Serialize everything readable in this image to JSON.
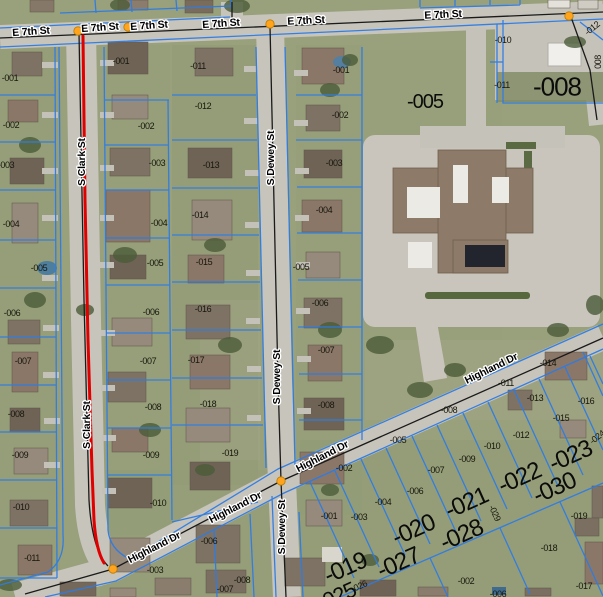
{
  "app": {
    "description": "GIS aerial parcel map viewer with highlighted route"
  },
  "colors": {
    "parcel_line": "#2d7ce6",
    "highlight_route": "#e10000",
    "intersection_node": "#ffa41c",
    "intersection_node_edge": "#b97a00",
    "road_fill": "#c7c4bb",
    "centerline": "#1a1a1a",
    "label_halo": "#ffffff"
  },
  "highlight": {
    "street": "S Clark St",
    "color": "#e10000"
  },
  "streets": {
    "labels": [
      {
        "text": "E 7th St",
        "x": 31,
        "y": 31,
        "angle": -4
      },
      {
        "text": "E 7th St",
        "x": 100,
        "y": 27,
        "angle": -4
      },
      {
        "text": "E 7th St",
        "x": 149,
        "y": 25,
        "angle": -4
      },
      {
        "text": "E 7th St",
        "x": 221,
        "y": 23,
        "angle": -4
      },
      {
        "text": "E 7th St",
        "x": 306,
        "y": 20,
        "angle": -3
      },
      {
        "text": "E 7th St",
        "x": 443,
        "y": 14,
        "angle": -3
      },
      {
        "text": "S Clark St",
        "x": 81,
        "y": 162,
        "angle": -90
      },
      {
        "text": "S Clark St",
        "x": 86,
        "y": 425,
        "angle": -90
      },
      {
        "text": "S Dewey St",
        "x": 270,
        "y": 158,
        "angle": -90
      },
      {
        "text": "S Dewey St",
        "x": 276,
        "y": 377,
        "angle": -90
      },
      {
        "text": "S Dewey St",
        "x": 281,
        "y": 527,
        "angle": -90
      },
      {
        "text": "Highland Dr",
        "x": 154,
        "y": 547,
        "angle": -27
      },
      {
        "text": "Highland Dr",
        "x": 235,
        "y": 507,
        "angle": -27
      },
      {
        "text": "Highland Dr",
        "x": 322,
        "y": 456,
        "angle": -27
      },
      {
        "text": "Highland Dr",
        "x": 491,
        "y": 368,
        "angle": -26
      }
    ]
  },
  "parcels": {
    "small_labels": [
      {
        "text": "-001",
        "x": 10,
        "y": 78
      },
      {
        "text": "-002",
        "x": 11,
        "y": 125
      },
      {
        "text": "-003",
        "x": 6,
        "y": 165
      },
      {
        "text": "-004",
        "x": 11,
        "y": 224
      },
      {
        "text": "-005",
        "x": 39,
        "y": 268
      },
      {
        "text": "-006",
        "x": 12,
        "y": 313
      },
      {
        "text": "-007",
        "x": 23,
        "y": 361
      },
      {
        "text": "-008",
        "x": 16,
        "y": 414
      },
      {
        "text": "-009",
        "x": 20,
        "y": 455
      },
      {
        "text": "-010",
        "x": 21,
        "y": 507
      },
      {
        "text": "-011",
        "x": 32,
        "y": 558
      },
      {
        "text": "-001",
        "x": 121,
        "y": 61
      },
      {
        "text": "-002",
        "x": 146,
        "y": 126
      },
      {
        "text": "-003",
        "x": 157,
        "y": 163
      },
      {
        "text": "-004",
        "x": 159,
        "y": 223
      },
      {
        "text": "-005",
        "x": 155,
        "y": 263
      },
      {
        "text": "-006",
        "x": 151,
        "y": 312
      },
      {
        "text": "-007",
        "x": 148,
        "y": 361
      },
      {
        "text": "-008",
        "x": 153,
        "y": 407
      },
      {
        "text": "-009",
        "x": 151,
        "y": 455
      },
      {
        "text": "-010",
        "x": 158,
        "y": 503
      },
      {
        "text": "-011",
        "x": 198,
        "y": 66
      },
      {
        "text": "-012",
        "x": 203,
        "y": 106
      },
      {
        "text": "-013",
        "x": 211,
        "y": 165
      },
      {
        "text": "-014",
        "x": 200,
        "y": 215
      },
      {
        "text": "-015",
        "x": 204,
        "y": 262
      },
      {
        "text": "-016",
        "x": 203,
        "y": 309
      },
      {
        "text": "-017",
        "x": 196,
        "y": 360
      },
      {
        "text": "-018",
        "x": 208,
        "y": 404
      },
      {
        "text": "-019",
        "x": 230,
        "y": 453
      },
      {
        "text": "-001",
        "x": 341,
        "y": 70
      },
      {
        "text": "-002",
        "x": 340,
        "y": 115
      },
      {
        "text": "-003",
        "x": 334,
        "y": 163
      },
      {
        "text": "-004",
        "x": 324,
        "y": 210
      },
      {
        "text": "-005",
        "x": 301,
        "y": 267
      },
      {
        "text": "-006",
        "x": 320,
        "y": 303
      },
      {
        "text": "-007",
        "x": 326,
        "y": 350
      },
      {
        "text": "-008",
        "x": 326,
        "y": 405
      },
      {
        "text": "-010",
        "x": 503,
        "y": 40
      },
      {
        "text": "-011",
        "x": 502,
        "y": 85
      },
      {
        "text": "-012",
        "x": 592,
        "y": 28,
        "angle": -38
      },
      {
        "text": "008",
        "x": 598,
        "y": 62,
        "angle": -90
      },
      {
        "text": "-014",
        "x": 548,
        "y": 363
      },
      {
        "text": "-011",
        "x": 506,
        "y": 383
      },
      {
        "text": "-013",
        "x": 535,
        "y": 398
      },
      {
        "text": "-016",
        "x": 586,
        "y": 401
      },
      {
        "text": "-008",
        "x": 449,
        "y": 410
      },
      {
        "text": "-015",
        "x": 561,
        "y": 418
      },
      {
        "text": "-012",
        "x": 521,
        "y": 435
      },
      {
        "text": "-024",
        "x": 597,
        "y": 437,
        "angle": -38
      },
      {
        "text": "-005",
        "x": 398,
        "y": 440
      },
      {
        "text": "-010",
        "x": 492,
        "y": 446
      },
      {
        "text": "-009",
        "x": 467,
        "y": 459
      },
      {
        "text": "-002",
        "x": 344,
        "y": 468
      },
      {
        "text": "-007",
        "x": 436,
        "y": 470
      },
      {
        "text": "-006",
        "x": 415,
        "y": 491
      },
      {
        "text": "-004",
        "x": 383,
        "y": 502
      },
      {
        "text": "-029",
        "x": 495,
        "y": 513,
        "angle": 65
      },
      {
        "text": "-001",
        "x": 329,
        "y": 516
      },
      {
        "text": "-003",
        "x": 359,
        "y": 517
      },
      {
        "text": "-019",
        "x": 579,
        "y": 516
      },
      {
        "text": "-006",
        "x": 209,
        "y": 541
      },
      {
        "text": "-018",
        "x": 549,
        "y": 548
      },
      {
        "text": "-003",
        "x": 155,
        "y": 570
      },
      {
        "text": "-008",
        "x": 242,
        "y": 580
      },
      {
        "text": "-002",
        "x": 466,
        "y": 581
      },
      {
        "text": "-026",
        "x": 359,
        "y": 586,
        "angle": -24
      },
      {
        "text": "-017",
        "x": 584,
        "y": 586
      },
      {
        "text": "-007",
        "x": 225,
        "y": 589
      },
      {
        "text": "-006",
        "x": 498,
        "y": 594
      }
    ],
    "large_labels": [
      {
        "text": "-005",
        "x": 425,
        "y": 101,
        "size": 20
      },
      {
        "text": "-008",
        "x": 557,
        "y": 86,
        "size": 26
      },
      {
        "text": "-019",
        "x": 345,
        "y": 567,
        "size": 24,
        "angle": -24
      },
      {
        "text": "-020",
        "x": 413,
        "y": 529,
        "size": 24,
        "angle": -24
      },
      {
        "text": "-021",
        "x": 466,
        "y": 502,
        "size": 24,
        "angle": -24
      },
      {
        "text": "-022",
        "x": 519,
        "y": 477,
        "size": 24,
        "angle": -24
      },
      {
        "text": "-023",
        "x": 570,
        "y": 455,
        "size": 24,
        "angle": -24
      },
      {
        "text": "-027",
        "x": 398,
        "y": 562,
        "size": 24,
        "angle": -24
      },
      {
        "text": "-028",
        "x": 461,
        "y": 534,
        "size": 24,
        "angle": -24
      },
      {
        "text": "-030",
        "x": 554,
        "y": 487,
        "size": 24,
        "angle": -24
      },
      {
        "text": "-025",
        "x": 336,
        "y": 596,
        "size": 22,
        "angle": -24
      }
    ]
  },
  "intersections": {
    "nodes": [
      {
        "x": 78,
        "y": 31
      },
      {
        "x": 128,
        "y": 27
      },
      {
        "x": 270,
        "y": 24
      },
      {
        "x": 569,
        "y": 16
      },
      {
        "x": 281,
        "y": 481
      },
      {
        "x": 113,
        "y": 569
      }
    ]
  }
}
